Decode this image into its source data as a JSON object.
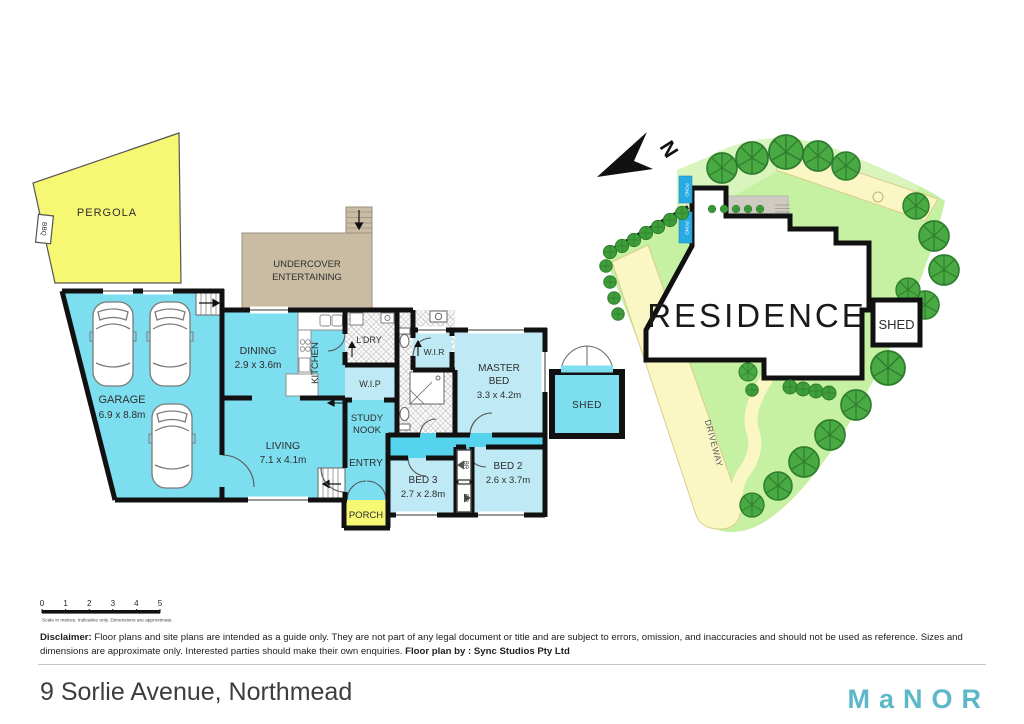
{
  "floor_plan": {
    "rooms": {
      "pergola": "PERGOLA",
      "bbq": "BBQ",
      "garage": "GARAGE",
      "garage_dims": "6.9 x 8.8m",
      "undercover1": "UNDERCOVER",
      "undercover2": "ENTERTAINING",
      "dining": "DINING",
      "dining_dims": "2.9 x 3.6m",
      "kitchen": "KITCHEN",
      "ldry": "L'DRY",
      "wip": "W.I.P",
      "wir": "W.I.R",
      "study1": "STUDY",
      "study2": "NOOK",
      "living": "LIVING",
      "living_dims": "7.1 x 4.1m",
      "entry": "ENTRY",
      "porch": "PORCH",
      "master1": "MASTER",
      "master2": "BED",
      "master_dims": "3.3 x 4.2m",
      "bed2": "BED 2",
      "bed2_dims": "2.6 x 3.7m",
      "bed3": "BED 3",
      "bed3_dims": "2.7 x 2.8m",
      "br1": "BR",
      "br2": "BR",
      "shed": "SHED"
    }
  },
  "site_plan": {
    "residence": "RESIDENCE",
    "shed": "SHED",
    "driveway": "DRIVEWAY",
    "pond1": "POND",
    "pond2": "POND",
    "north": "N"
  },
  "scale_bar": {
    "ticks": [
      "0",
      "1",
      "2",
      "3",
      "4",
      "5"
    ],
    "caption": "Scale in metres. Indicative only. Dimensions are approximate."
  },
  "disclaimer": {
    "label": "Disclaimer:",
    "line1": "Floor plans and site plans are intended as a guide only. They are not part of any legal document or title and are subject to errors, omission, and inaccuracies and should not be used as reference.",
    "line2": "Sizes and dimensions are approximate only. Interested parties should make their own enquiries.",
    "credit": "Floor plan by : Sync Studios Pty Ltd"
  },
  "footer": {
    "address": "9 Sorlie Avenue, Northmead",
    "brand": "MaNOR"
  },
  "colors": {
    "room_cyan": "#7ddef0",
    "room_light": "#bfe9f4",
    "hall_cyan": "#56d4ee",
    "yellow": "#f6f772",
    "tan": "#c9bca3",
    "lawn": "#c6f0a2",
    "path_yellow": "#fbf7c5",
    "tree_green": "#49a942",
    "pond_blue": "#29abe2",
    "wall": "#111111",
    "brand_teal": "#5cb8c8"
  }
}
